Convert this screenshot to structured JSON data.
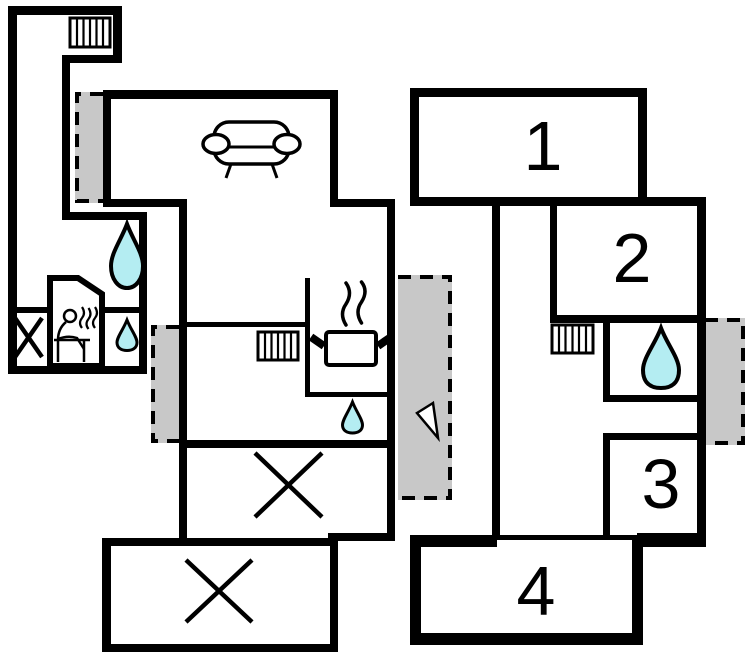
{
  "plan": {
    "type": "holiday-home-floor-plan",
    "room_labels": [
      "1",
      "2",
      "3",
      "4"
    ],
    "colors": {
      "wall": "#000000",
      "door_marker": "#c8c8c8",
      "water": "#b4edf2",
      "steam": "#999999",
      "background": "#ffffff"
    },
    "icons": [
      {
        "name": "radiator-icon",
        "count": 3
      },
      {
        "name": "water-drop-icon",
        "count": 4
      },
      {
        "name": "sofa-icon",
        "count": 1
      },
      {
        "name": "cooking-pot-icon",
        "count": 1
      },
      {
        "name": "sauna-icon",
        "count": 1
      },
      {
        "name": "cross-marker",
        "count": 3
      },
      {
        "name": "door-marker",
        "count": 4
      },
      {
        "name": "entrance-arrow-icon",
        "count": 1
      }
    ]
  }
}
